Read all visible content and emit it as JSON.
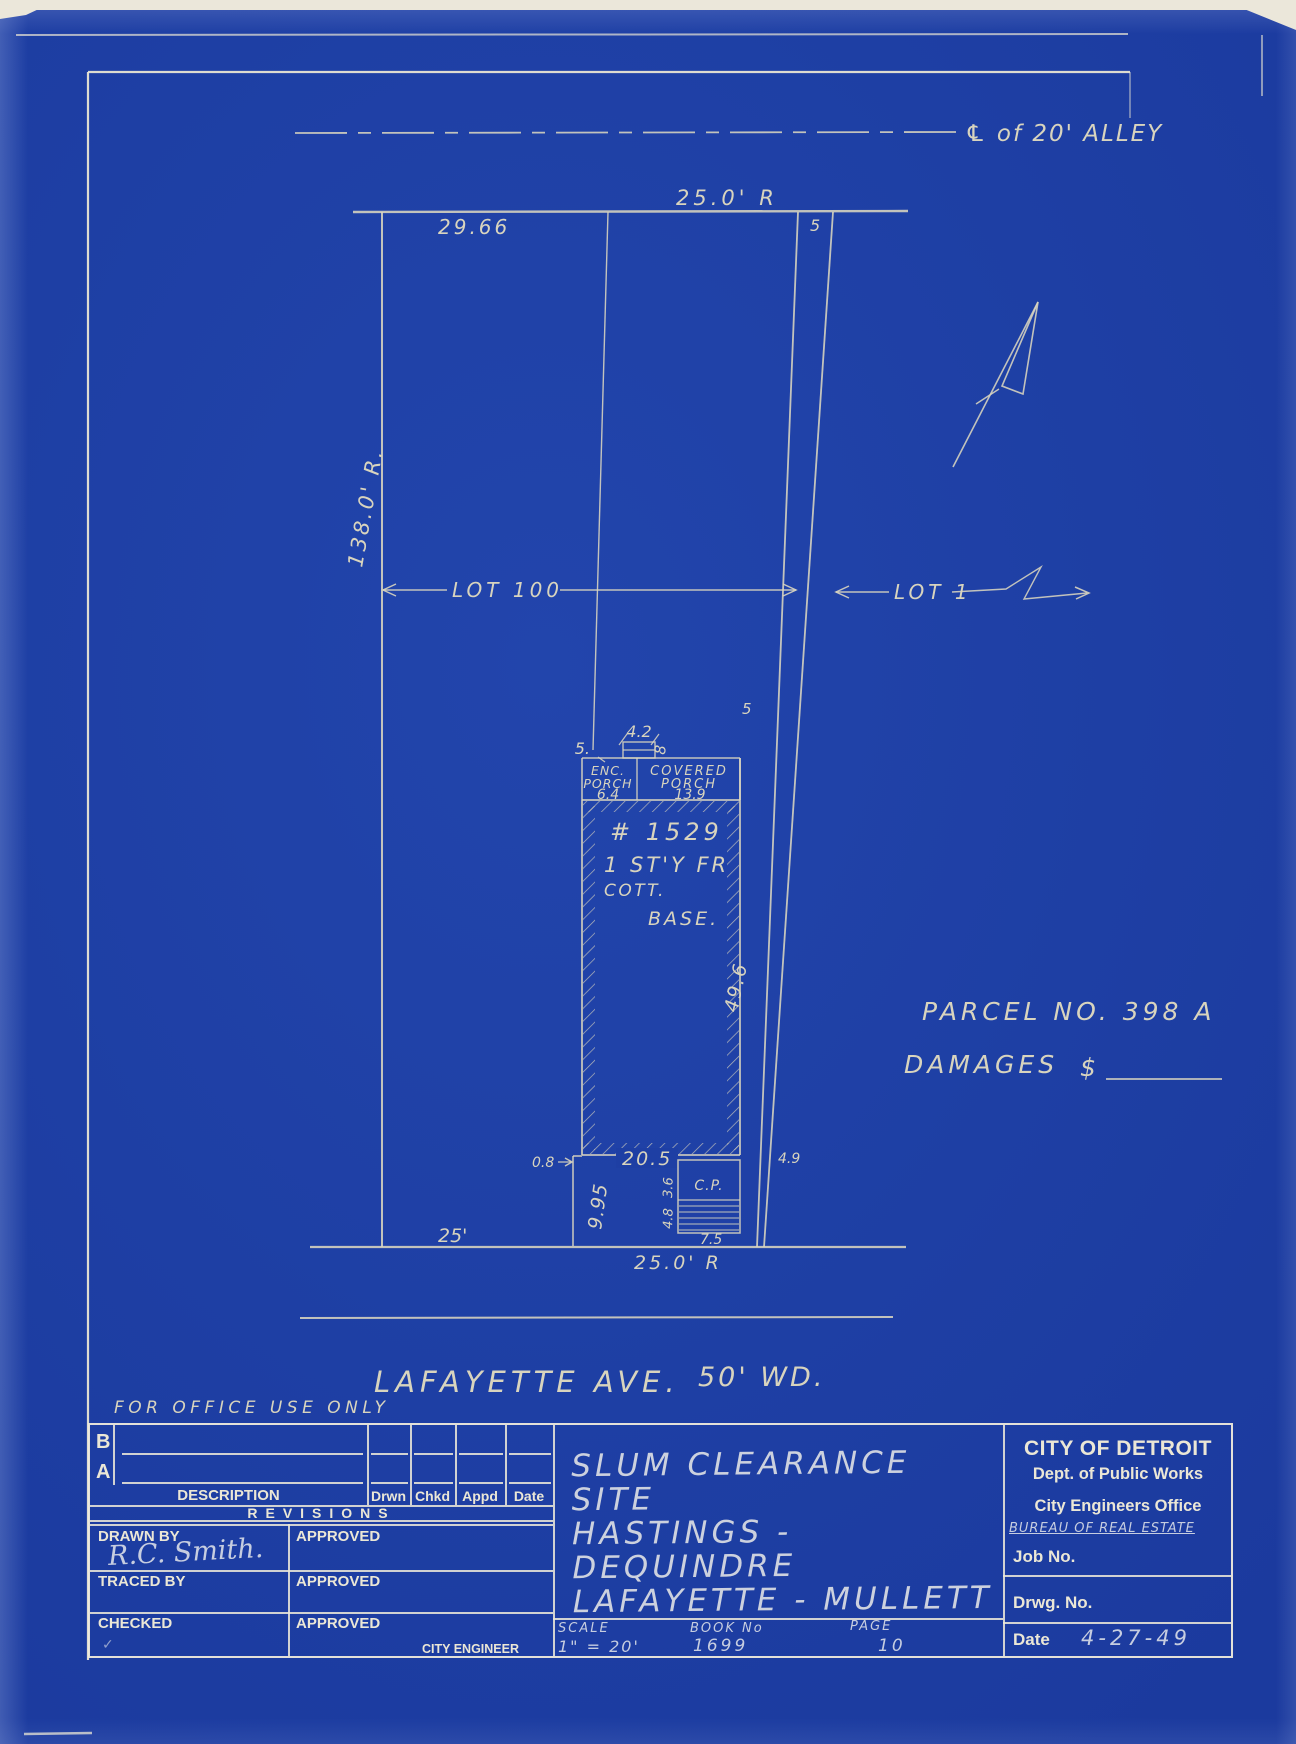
{
  "colors": {
    "paper_blue": "#1e3fa4",
    "ink_cream": "#d9d5bf",
    "ink_bright": "#ebe7d6",
    "pencil_blue_white": "#c6cde0"
  },
  "plan": {
    "alley_label": "℄ of 20' ALLEY",
    "width_top": "25.0' R",
    "offset_top": "29.66",
    "strip_top": "5",
    "depth_left": "138.0' R.",
    "lot_100": "LOT 100",
    "lot_1": "LOT 1",
    "bay_width": "4.2",
    "bay_depth": "8",
    "setback_left": "5.",
    "setback_right": "5",
    "enc_porch_line1": "ENC.",
    "enc_porch_line2": "PORCH",
    "enc_porch_dim": "6.4",
    "cov_porch_line1": "COVERED",
    "cov_porch_line2": "PORCH",
    "cov_porch_dim": "13.9",
    "house_no": "# 1529",
    "story": "1 ST'Y FR",
    "cott": "COTT.",
    "base": "BASE.",
    "side_depth": "49.6",
    "jog": "0.8",
    "rear_width": "20.5",
    "gap_right": "4.9",
    "ext_depth": "9.95",
    "cp": "C.P.",
    "cp_dim1": "3.6",
    "cp_dim2": "4.8",
    "cp_width": "7.5",
    "front_left": "25'",
    "width_bottom": "25.0' R",
    "street_name": "LAFAYETTE AVE.",
    "street_width": "50' WD.",
    "parcel": "PARCEL NO. 398 A",
    "damages_label": "DAMAGES",
    "damages_currency": "$",
    "office_note": "FOR OFFICE USE ONLY"
  },
  "titleblock": {
    "rev_b": "B",
    "rev_a": "A",
    "description": "DESCRIPTION",
    "drwn": "Drwn",
    "chkd": "Chkd",
    "appd": "Appd",
    "date_col": "Date",
    "revisions": "REVISIONS",
    "drawn_by": "DRAWN BY",
    "approved1": "APPROVED",
    "drawn_by_value": "R.C. Smith.",
    "traced_by": "TRACED BY",
    "approved2": "APPROVED",
    "checked": "CHECKED",
    "checked_mark": "✓",
    "approved3": "APPROVED",
    "city_engineer": "CITY ENGINEER",
    "title_line1": "SLUM CLEARANCE SITE",
    "title_line2": "HASTINGS - DEQUINDRE",
    "title_line3": "LAFAYETTE - MULLETT",
    "scale_label": "SCALE",
    "scale_value": "1\" = 20'",
    "book_label": "BOOK No",
    "book_value": "1699",
    "page_label": "PAGE",
    "page_value": "10",
    "org_line1": "CITY OF DETROIT",
    "org_line2": "Dept. of Public Works",
    "org_line3": "City Engineers Office",
    "org_line4": "BUREAU OF REAL ESTATE",
    "job_no": "Job No.",
    "drwg_no": "Drwg. No.",
    "date_label": "Date",
    "date_value": "4-27-49"
  }
}
